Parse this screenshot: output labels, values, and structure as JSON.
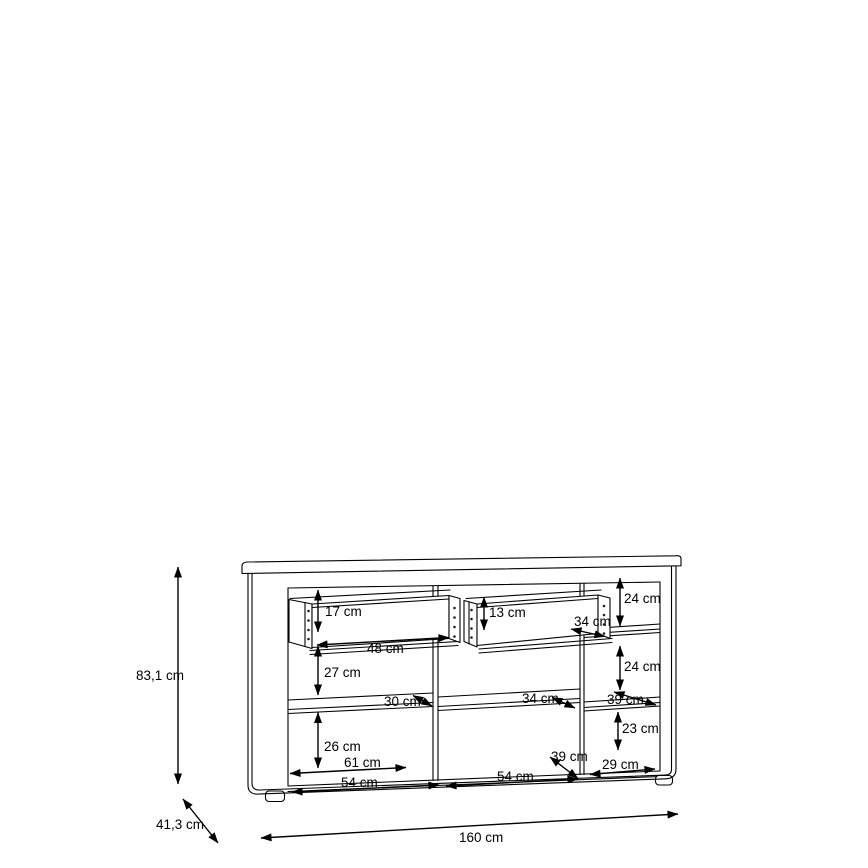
{
  "colors": {
    "background": "#ffffff",
    "line": "#000000"
  },
  "diagram": {
    "overall": {
      "height": "83,1 cm",
      "depth": "41,3 cm",
      "width": "160 cm"
    },
    "labels": {
      "drawer_left_height": "17 cm",
      "drawer_left_width": "48 cm",
      "left_upper_compartment_height": "27 cm",
      "left_shelf_depth": "30 cm",
      "left_lower_compartment_height": "26 cm",
      "left_shelf_width": "61 cm",
      "left_compartment_width": "54 cm",
      "drawer_mid_height": "13 cm",
      "drawer_mid_width": "34 cm",
      "mid_shelf_depth": "34 cm",
      "mid_floor_depth": "39 cm",
      "mid_compartment_width": "54 cm",
      "right_top_compartment_height": "24 cm",
      "right_mid_compartment_height": "24 cm",
      "right_shelf_depth": "39 cm",
      "right_lower_compartment_height": "23 cm",
      "right_compartment_width": "29 cm"
    }
  }
}
